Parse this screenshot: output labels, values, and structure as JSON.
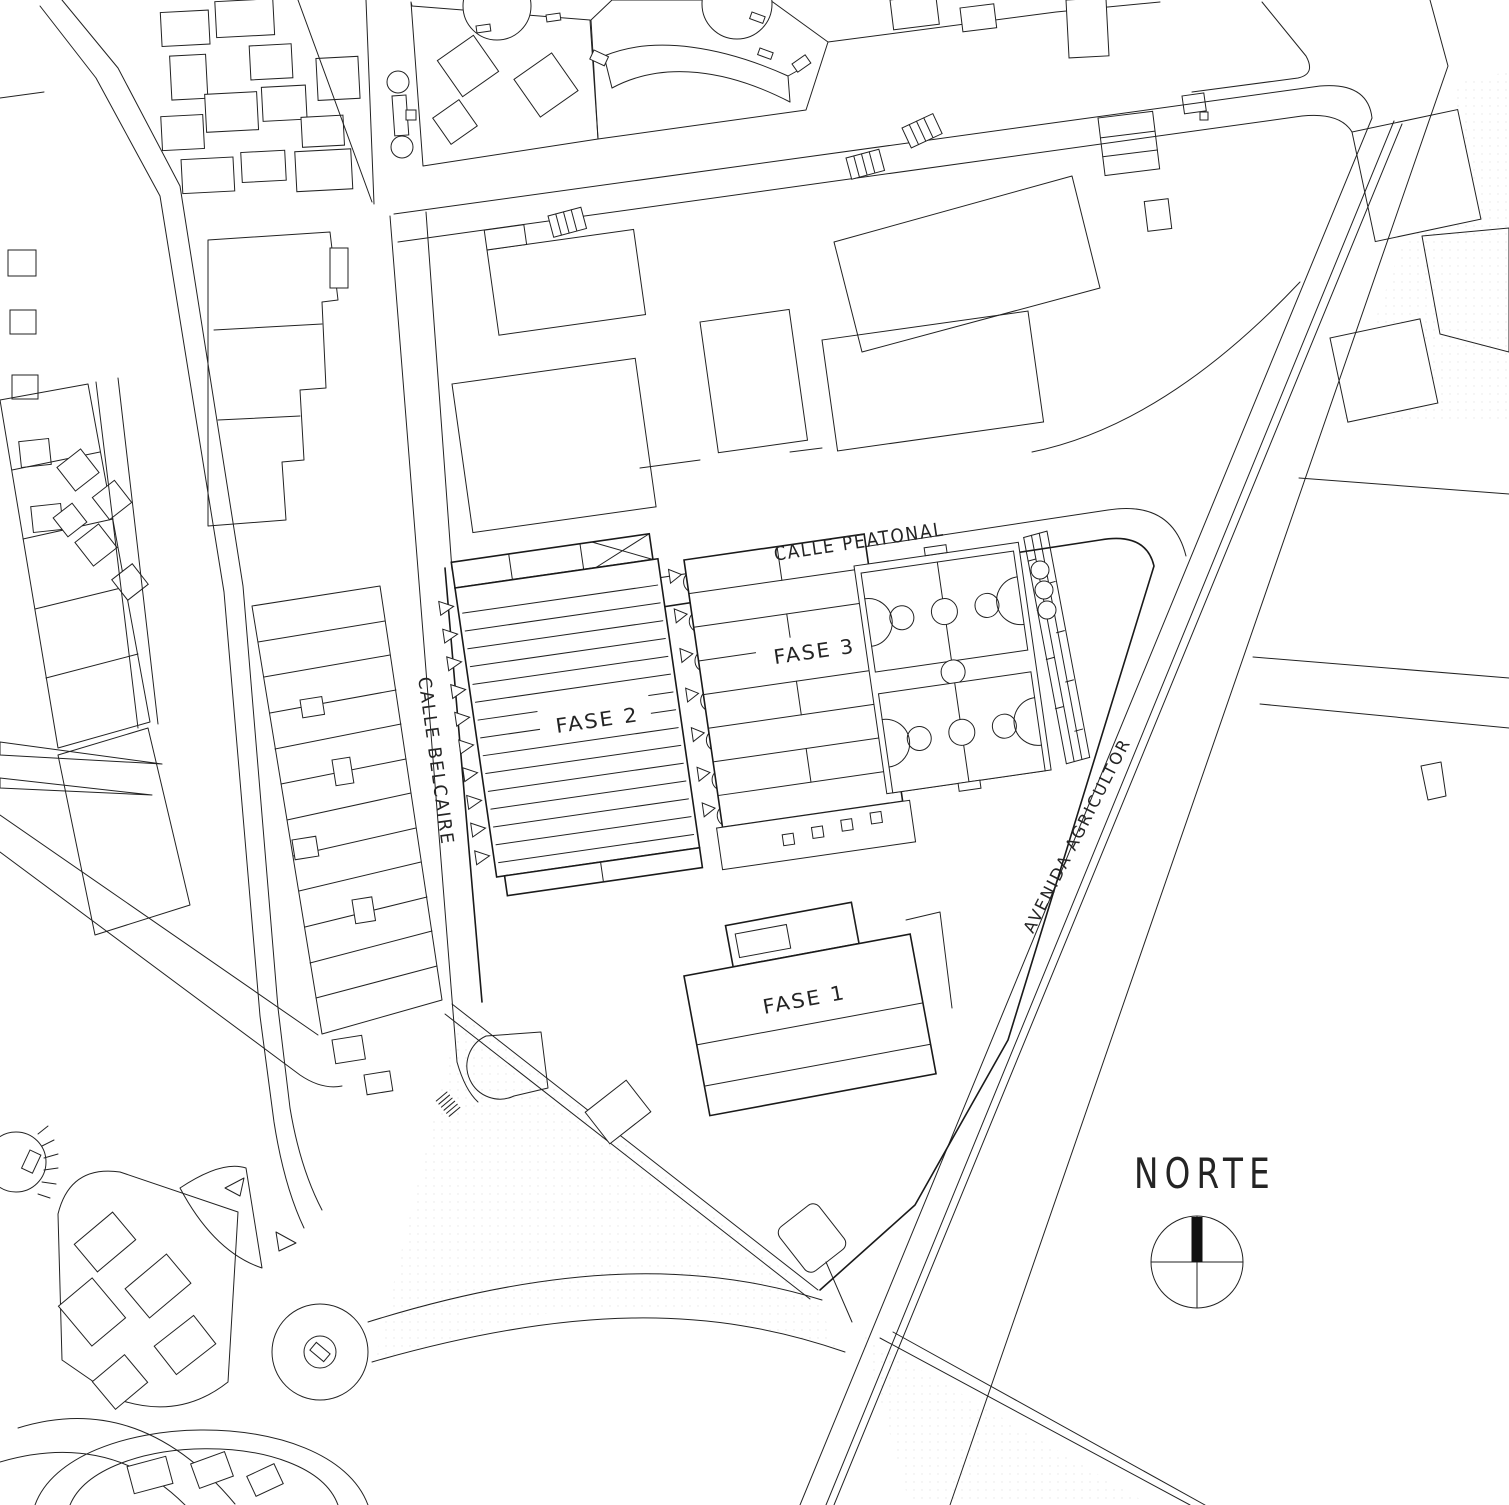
{
  "plan": {
    "streets": {
      "peatonal": {
        "label": "CALLE PEATONAL"
      },
      "belcaire": {
        "label": "CALLE BELCAIRE"
      },
      "agricultor": {
        "label": "AVENIDA AGRICULTOR"
      }
    },
    "phases": {
      "fase1": {
        "label": "FASE 1"
      },
      "fase2": {
        "label": "FASE 2"
      },
      "fase3": {
        "label": "FASE 3"
      }
    },
    "compass": {
      "label": "NORTE",
      "icon": "north-compass-icon"
    },
    "colors": {
      "line": "#222222",
      "background": "#ffffff",
      "compass_needle": "#111111"
    }
  }
}
